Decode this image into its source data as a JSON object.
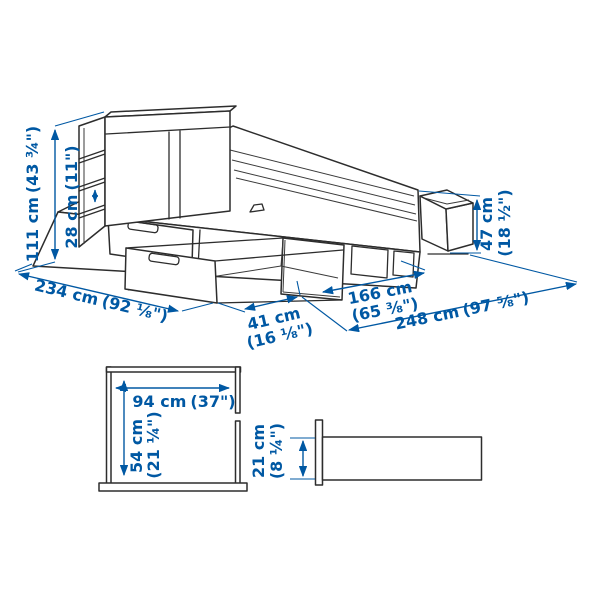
{
  "colors": {
    "dimension_blue": "#0058a3",
    "outline_dark": "#2d2d2d",
    "background": "#ffffff"
  },
  "bed_view": {
    "description": "bed frame with storage drawers and storage headboard, isometric line drawing",
    "dimensions": {
      "total_height": {
        "metric": "111 cm",
        "imperial": "(43 ¾\")"
      },
      "headboard_compartment": {
        "metric": "28 cm",
        "imperial": "(11\")"
      },
      "total_length": {
        "metric": "234 cm",
        "imperial": "(92 ⅛\")"
      },
      "drawer_extension": {
        "metric": "41 cm",
        "imperial": "(16 ⅛\")"
      },
      "bed_width": {
        "metric": "166 cm",
        "imperial": "(65 ⅜\")"
      },
      "width_with_drawers_open": {
        "metric": "248 cm",
        "imperial": "(97 ⅝\")"
      },
      "footboard_height": {
        "metric": "47 cm",
        "imperial": "(18 ½\")"
      }
    }
  },
  "drawer_view": {
    "description": "storage drawer top view",
    "dimensions": {
      "width": {
        "metric": "94 cm",
        "imperial": "(37\")"
      },
      "depth": {
        "metric": "54 cm",
        "imperial": "(21 ¼\")"
      }
    }
  },
  "clearance_view": {
    "description": "bed side rail section view",
    "dimensions": {
      "height": {
        "metric": "21 cm",
        "imperial": "(8 ¼\")"
      }
    }
  }
}
